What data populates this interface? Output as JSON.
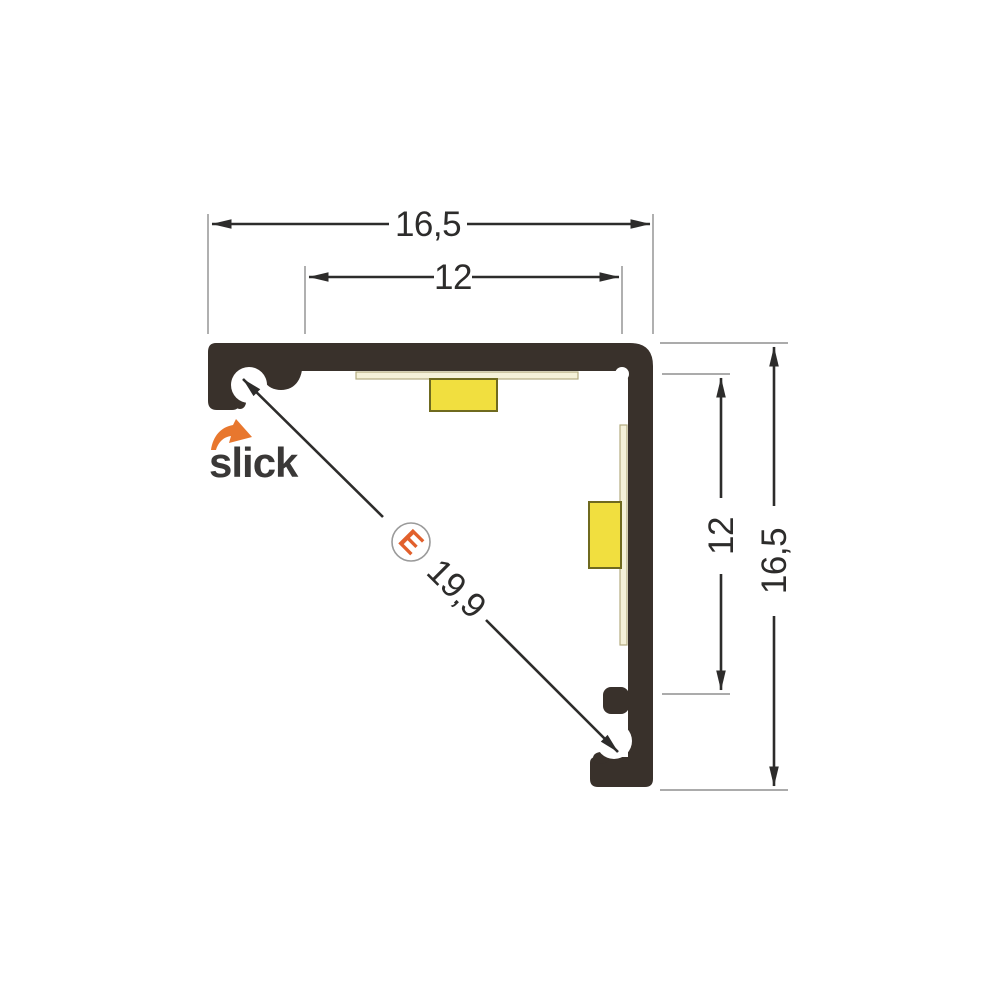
{
  "drawing": {
    "type": "technical-cross-section",
    "logo": {
      "text": "slick"
    },
    "marker": {
      "label": "E"
    },
    "dimensions": {
      "top_outer": "16,5",
      "top_inner": "12",
      "right_inner": "12",
      "right_outer": "16,5",
      "diagonal": "19,9"
    },
    "colors": {
      "background": "#ffffff",
      "profile": "#39312b",
      "led": "#f1df3f",
      "led_border": "#6f6a1f",
      "pcb": "#f5f1d9",
      "pcb_border": "#b3ac81",
      "dim_line": "#2d2c2b",
      "ext_line": "#8f8f8f",
      "marker_circle_outline": "#9a9a9a",
      "accent_orange": "#e2602c",
      "logo_orange": "#e8772e",
      "logo_text": "#3a3837"
    }
  }
}
